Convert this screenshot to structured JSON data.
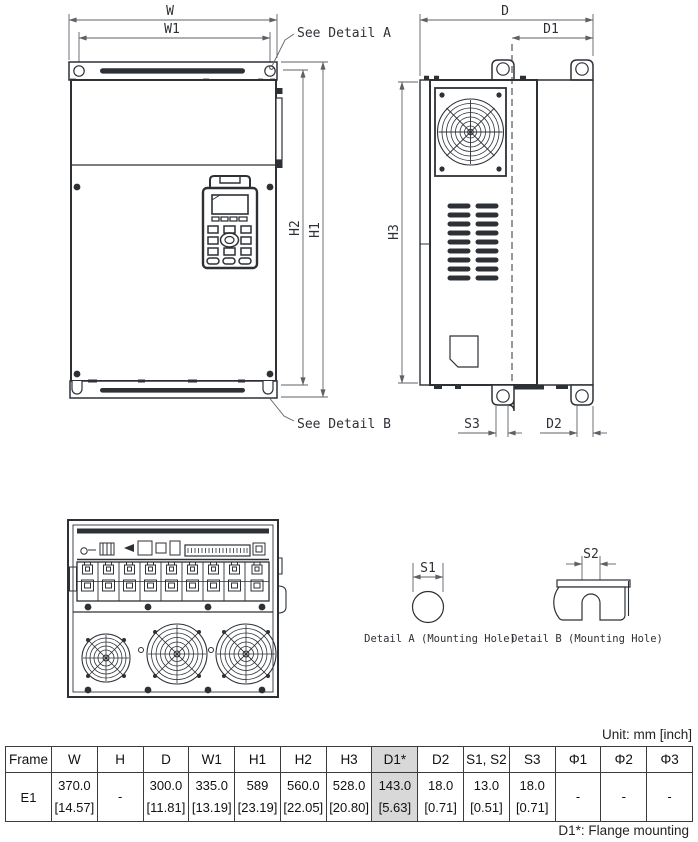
{
  "drawing": {
    "labels": {
      "w": "W",
      "w1": "W1",
      "h1": "H1",
      "h2": "H2",
      "h3": "H3",
      "d": "D",
      "d1": "D1",
      "d2": "D2",
      "s1": "S1",
      "s2": "S2",
      "s3": "S3"
    },
    "callouts": {
      "see_detail_a": "See Detail A",
      "see_detail_b": "See Detail B"
    },
    "captions": {
      "detail_a": "Detail A (Mounting Hole)",
      "detail_b": "Detail B (Mounting Hole)"
    }
  },
  "table": {
    "unit_note": "Unit: mm [inch]",
    "footnote": "D1*: Flange mounting",
    "columns": [
      "Frame",
      "W",
      "H",
      "D",
      "W1",
      "H1",
      "H2",
      "H3",
      "D1*",
      "D2",
      "S1, S2",
      "S3",
      "Φ1",
      "Φ2",
      "Φ3"
    ],
    "frame": "E1",
    "mm": [
      "370.0",
      "-",
      "300.0",
      "335.0",
      "589",
      "560.0",
      "528.0",
      "143.0",
      "18.0",
      "13.0",
      "18.0",
      "-",
      "-",
      "-"
    ],
    "inch": [
      "[14.57]",
      "",
      "[11.81]",
      "[13.19]",
      "[23.19]",
      "[22.05]",
      "[20.80]",
      "[5.63]",
      "[0.71]",
      "[0.51]",
      "[0.71]",
      "",
      "",
      ""
    ]
  },
  "colors": {
    "line": "#2d3136",
    "highlight": "#d8d8d8"
  }
}
